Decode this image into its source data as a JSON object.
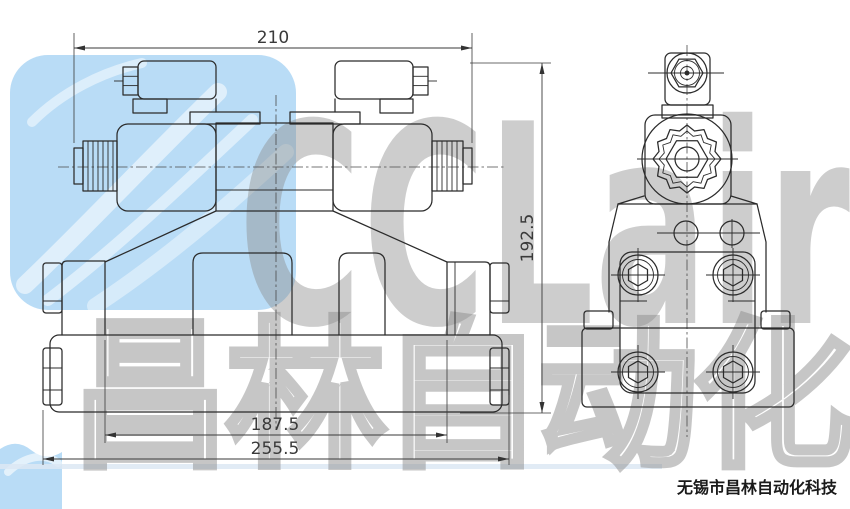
{
  "page": {
    "width": 850,
    "height": 509,
    "background": "#ffffff"
  },
  "drawing": {
    "subject": "solenoid-directional-valve-two-view-technical-drawing",
    "line_color": "#2b2b2b",
    "views": {
      "front": "front-view-with-two-solenoids",
      "side": "side-view-with-mounting-bolts"
    },
    "dimensions": {
      "width_top": "210",
      "height_right": "192.5",
      "width_inner": "187.5",
      "width_overall": "255.5"
    }
  },
  "watermark": {
    "logo_text": "CCLair",
    "cjk_text": "昌林自动化",
    "tile_color": "#b9dcf6",
    "text_color": "#8a8a8a"
  },
  "footer": {
    "company": "无锡市昌林自动化科技",
    "color": "#1a1a1a"
  }
}
